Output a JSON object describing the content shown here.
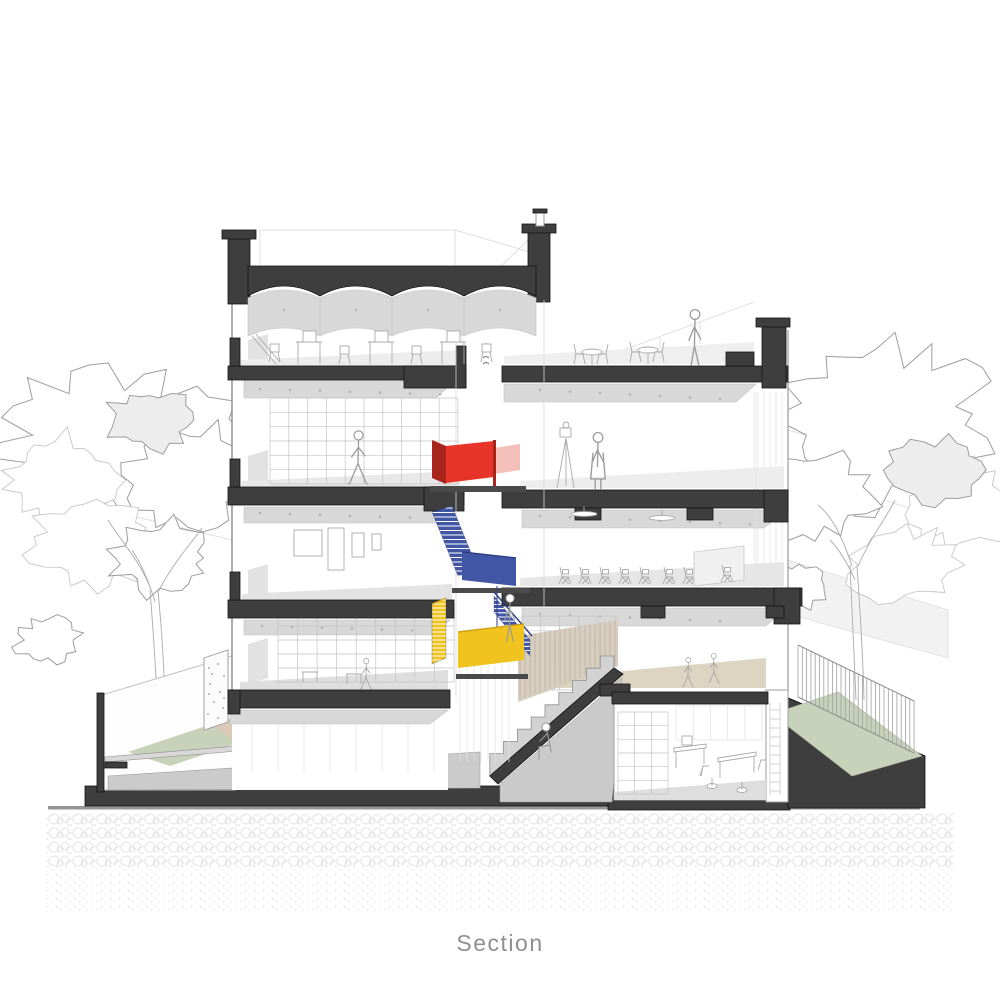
{
  "caption": "Section",
  "colors": {
    "paper": "#ffffff",
    "caption": "#8f8f8f",
    "cut": "#3e3e3e",
    "red": "#e73428",
    "red_dark": "#a8251c",
    "red_pale": "#f2b3ad",
    "blue": "#4156a5",
    "blue_dark": "#2d3e85",
    "yellow": "#f1c31e",
    "yellow_dark": "#cfa013",
    "green": "#c8d2ba",
    "wood": "#d8cec0",
    "wood_line": "#b9ad9b",
    "beige_floor": "#ddd4c2",
    "figure": "#9b9b9b"
  }
}
